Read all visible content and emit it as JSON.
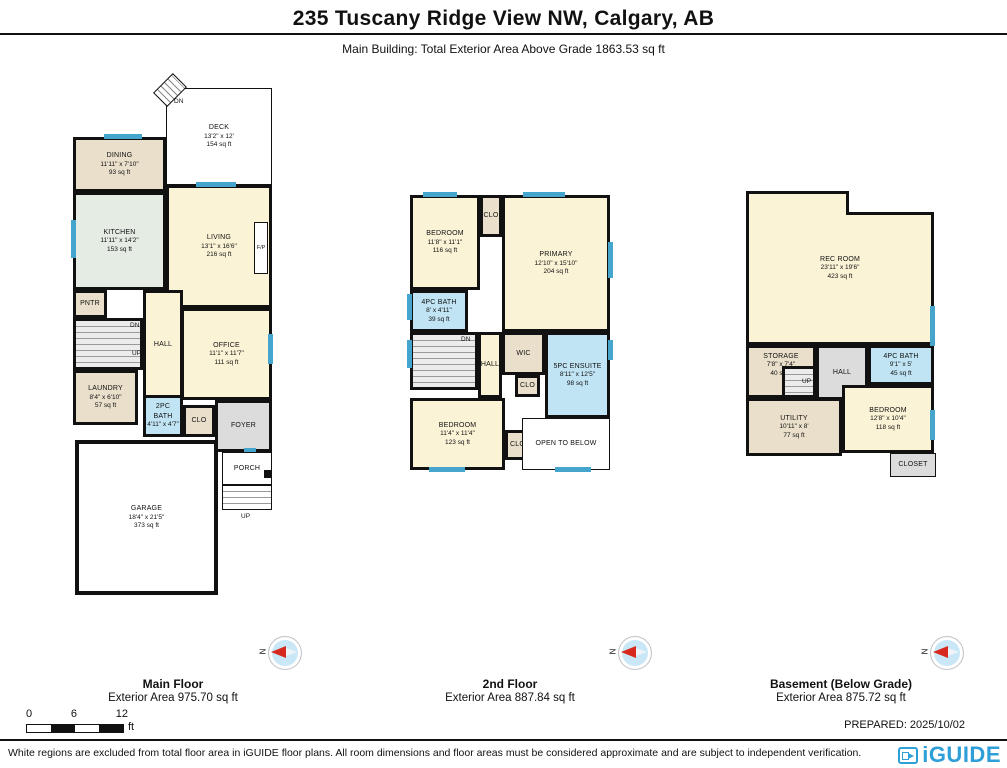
{
  "header": {
    "title": "235 Tuscany Ridge View NW, Calgary, AB",
    "subtitle": "Main Building: Total Exterior Area Above Grade 1863.53 sq ft"
  },
  "floors": [
    {
      "caption": {
        "name": "Main Floor",
        "area": "Exterior Area 975.70 sq ft"
      },
      "rooms": {
        "deck": {
          "name": "DECK",
          "dims": "13'2\" x 12'",
          "area": "154 sq ft"
        },
        "dining": {
          "name": "DINING",
          "dims": "11'11\" x 7'10\"",
          "area": "93 sq ft"
        },
        "kitchen": {
          "name": "KITCHEN",
          "dims": "11'11\" x 14'2\"",
          "area": "153 sq ft"
        },
        "living": {
          "name": "LIVING",
          "dims": "13'1\" x 16'6\"",
          "area": "216 sq ft"
        },
        "pntr": {
          "name": "PNTR"
        },
        "office": {
          "name": "OFFICE",
          "dims": "11'1\" x 11'7\"",
          "area": "111 sq ft"
        },
        "hall": {
          "name": "HALL"
        },
        "laundry": {
          "name": "LAUNDRY",
          "dims": "8'4\" x 6'10\"",
          "area": "57 sq ft"
        },
        "bath": {
          "name": "2PC BATH",
          "dims": "4'11\" x 4'7\""
        },
        "clo": {
          "name": "CLO"
        },
        "foyer": {
          "name": "FOYER"
        },
        "porch": {
          "name": "PORCH"
        },
        "garage": {
          "name": "GARAGE",
          "dims": "18'4\" x 21'5\"",
          "area": "373 sq ft"
        }
      },
      "labels": {
        "deck_dn": "DN",
        "dn": "DN",
        "up": "UP",
        "fp": "F/P",
        "porch_up": "UP"
      }
    },
    {
      "caption": {
        "name": "2nd Floor",
        "area": "Exterior Area 887.84 sq ft"
      },
      "rooms": {
        "bedroom1": {
          "name": "BEDROOM",
          "dims": "11'8\" x 11'1\"",
          "area": "116 sq ft"
        },
        "clo_top": {
          "name": "CLO"
        },
        "primary": {
          "name": "PRIMARY",
          "dims": "12'10\" x 15'10\"",
          "area": "204 sq ft"
        },
        "bath": {
          "name": "4PC BATH",
          "dims": "8' x 4'11\"",
          "area": "39 sq ft"
        },
        "wic": {
          "name": "WIC"
        },
        "ensuite": {
          "name": "5PC ENSUITE",
          "dims": "8'11\" x 12'5\"",
          "area": "98 sq ft"
        },
        "hall": {
          "name": "HALL"
        },
        "clo_mid": {
          "name": "CLO"
        },
        "bedroom2": {
          "name": "BEDROOM",
          "dims": "11'4\" x 11'4\"",
          "area": "123 sq ft"
        },
        "clo_bot": {
          "name": "CLO"
        },
        "open": {
          "name": "OPEN TO BELOW"
        }
      },
      "labels": {
        "dn": "DN"
      }
    },
    {
      "caption": {
        "name": "Basement (Below Grade)",
        "area": "Exterior Area 875.72 sq ft"
      },
      "rooms": {
        "rec": {
          "name": "REC ROOM",
          "dims": "23'11\" x 19'6\"",
          "area": "423 sq ft"
        },
        "storage": {
          "name": "STORAGE",
          "dims": "7'8\" x 7'4\"",
          "area": "40 sq ft"
        },
        "hall": {
          "name": "HALL"
        },
        "bath": {
          "name": "4PC BATH",
          "dims": "9'1\" x 5'",
          "area": "45 sq ft"
        },
        "utility": {
          "name": "UTILITY",
          "dims": "10'11\" x 8'",
          "area": "77 sq ft"
        },
        "bedroom": {
          "name": "BEDROOM",
          "dims": "12'8\" x 10'4\"",
          "area": "118 sq ft"
        },
        "closet": {
          "name": "CLOSET"
        }
      },
      "labels": {
        "up": "UP"
      }
    }
  ],
  "compass": {
    "label": "N"
  },
  "scale_bar": {
    "tick0": "0",
    "tick1": "6",
    "tick2": "12",
    "unit": "ft"
  },
  "prepared": "PREPARED: 2025/10/02",
  "footer": {
    "disclaimer": "White regions are excluded from total floor area in iGUIDE floor plans. All room dimensions and floor areas must be considered approximate and are subject to independent verification.",
    "brand": "iGUIDE"
  },
  "palette": {
    "wall": "#111111",
    "window": "#45a5cd",
    "room_cream": "#fbf3d6",
    "room_tan": "#e9dfca",
    "room_mint": "#e5ece4",
    "room_bath": "#c0e4f4",
    "room_gray": "#dcdcdc",
    "brand_blue": "#2f9fd8",
    "compass_red": "#d6281e"
  }
}
